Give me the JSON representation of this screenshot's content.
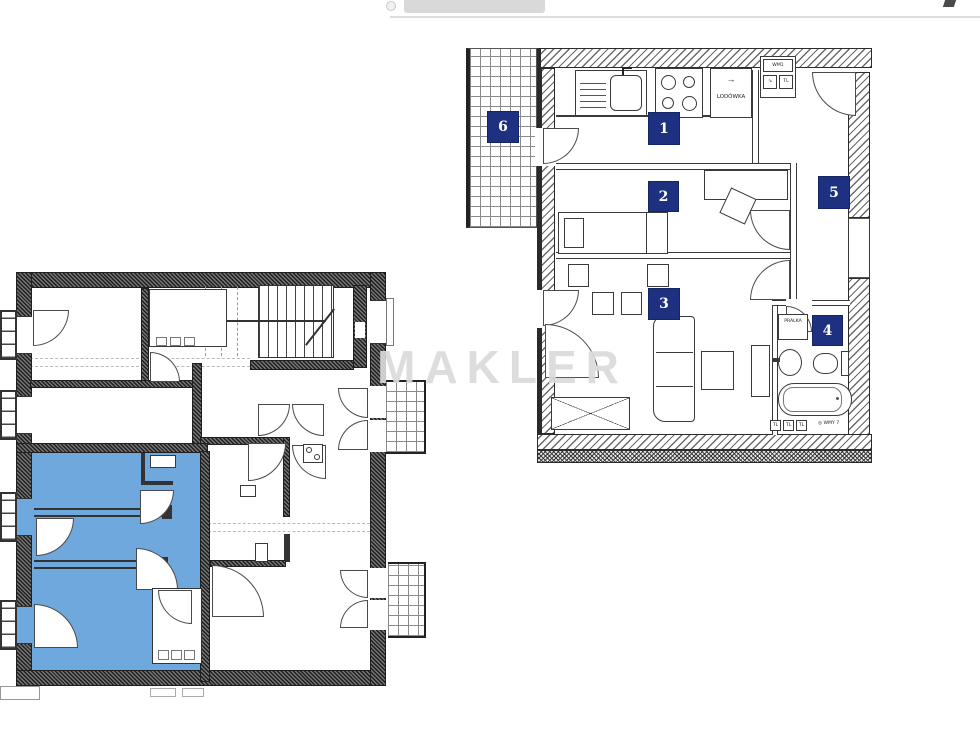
{
  "watermark": {
    "text": "MAKLER"
  },
  "right_plan": {
    "room_badges": [
      "1",
      "2",
      "3",
      "4",
      "5",
      "6"
    ],
    "labels": {
      "fridge": "LODÓWKA",
      "fridge_arrow": "→",
      "washer": "PRALKA",
      "meter_top": "WM1",
      "meter_arrow": "↘",
      "meter_tl": "TL",
      "vents": [
        "TL",
        "TL",
        "TL"
      ],
      "meter_note_icon": "◎",
      "meter_note": "WMY 7"
    }
  },
  "left_plan": {
    "highlighted_unit_color": "#6fa8dc"
  },
  "colors": {
    "room_badge_bg": "#1e3080",
    "watermark_gray": "#d9d9d9"
  }
}
